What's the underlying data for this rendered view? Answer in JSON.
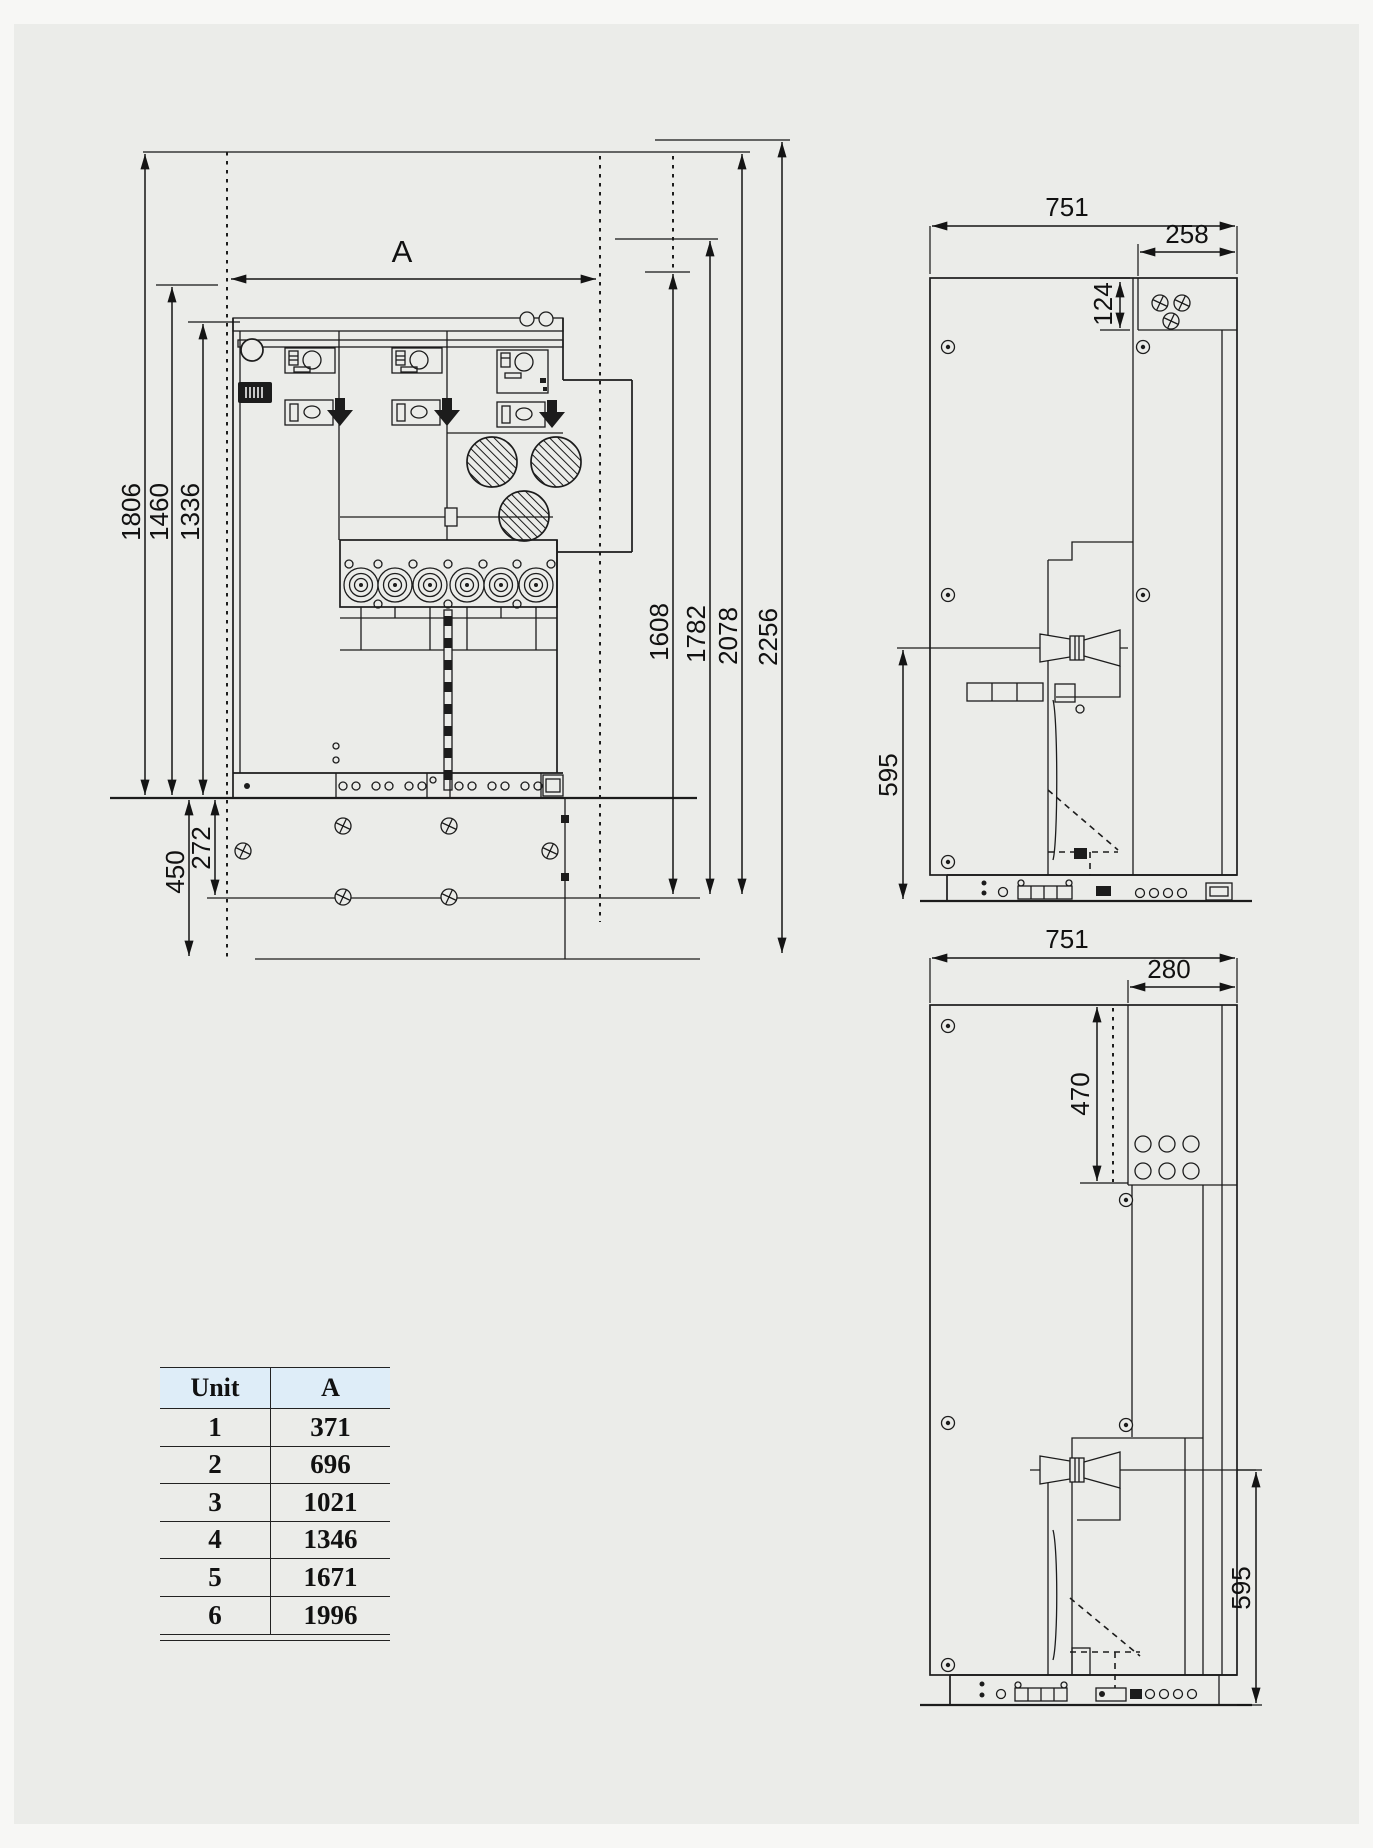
{
  "page": {
    "background": "#ebece9",
    "line_color": "#1c1c1c",
    "table_header_bg": "#deedf8"
  },
  "front_view": {
    "label": "switchgear front elevation",
    "dims": {
      "width": "A",
      "h_total": "1806",
      "h_mid": "1460",
      "h_body": "1336",
      "pit_total": "450",
      "pit_mid": "272",
      "r1": "1608",
      "r2": "1782",
      "r3": "2078",
      "r4": "2256"
    }
  },
  "side_view_top": {
    "label": "side section upper",
    "dims": {
      "width": "751",
      "top_width": "258",
      "top_height": "124",
      "bushing_height": "595"
    }
  },
  "side_view_bottom": {
    "label": "side section lower",
    "dims": {
      "width": "751",
      "door_width": "280",
      "door_height": "470",
      "bushing_height": "595"
    }
  },
  "unit_table": {
    "headers": [
      "Unit",
      "A"
    ],
    "rows": [
      [
        "1",
        "371"
      ],
      [
        "2",
        "696"
      ],
      [
        "3",
        "1021"
      ],
      [
        "4",
        "1346"
      ],
      [
        "5",
        "1671"
      ],
      [
        "6",
        "1996"
      ]
    ]
  }
}
